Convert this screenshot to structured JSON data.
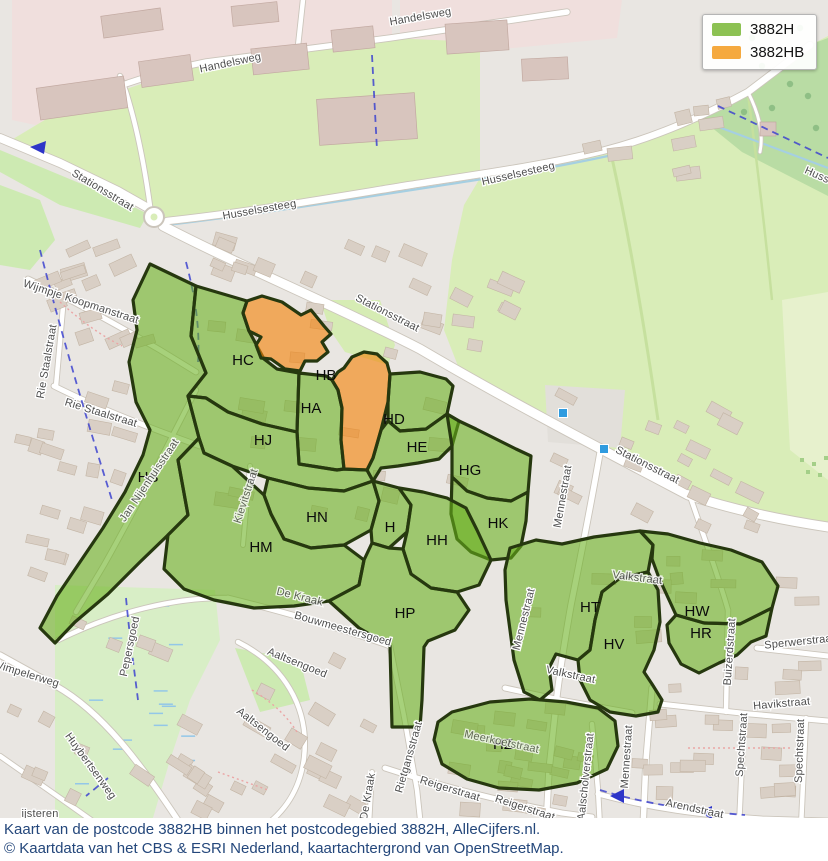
{
  "legend": {
    "items": [
      {
        "label": "3882H",
        "color": "#8cc152"
      },
      {
        "label": "3882HB",
        "color": "#f5a93f"
      }
    ]
  },
  "caption": {
    "line1": "Kaart van de postcode 3882HB binnen het postcodegebied 3882H, AlleCijfers.nl.",
    "line2": "© Kaartdata van het CBS & ESRI Nederland, kaartachtergrond van OpenStreetMap."
  },
  "colors": {
    "base": "#e9e6e2",
    "zone_green_fill": "rgba(104,176,28,0.58)",
    "zone_orange_fill": "rgba(243,130,10,0.62)",
    "zone_stroke": "#26380f",
    "road_casing": "#cbc5bb",
    "road_fill": "#ffffff",
    "stream": "#a5cfe2",
    "cycleway": "#3d43cf",
    "building": "#d9cfc5",
    "building_stroke": "#c3b5a5",
    "industrial_building": "#d8c5be",
    "bus_stop": "#2f9bdf"
  },
  "map": {
    "zone_polygons": [
      {
        "id": "HS",
        "type": "h",
        "points": "150,264 196,286 191,336 206,373 188,396 199,438 178,460 188,515 168,535 140,562 108,594 75,622 55,643 40,628 57,596 80,562 103,528 125,492 143,455 150,430 136,402 129,362 137,330 133,300"
      },
      {
        "id": "HC",
        "type": "h",
        "points": "196,286 247,301 243,313 249,331 257,346 264,359 277,369 299,373 297,432 262,424 228,412 206,398 188,396 206,373 191,336"
      },
      {
        "id": "HA",
        "type": "h",
        "points": "299,373 326,376 332,380 338,390 342,408 341,440 344,469 337,470 299,464 297,432"
      },
      {
        "id": "HJ",
        "type": "h",
        "points": "188,396 206,398 228,412 262,424 297,432 299,464 337,470 344,469 367,470 373,481 344,491 308,488 268,478 232,466 204,453 199,438"
      },
      {
        "id": "HD",
        "type": "h",
        "points": "390,374 420,372 446,379 453,386 447,414 426,429 400,431 388,421 388,402"
      },
      {
        "id": "HE",
        "type": "h",
        "points": "388,421 400,431 426,429 447,414 459,421 452,446 439,459 418,463 398,466 381,468 373,481 367,470 373,458 381,430"
      },
      {
        "id": "HG",
        "type": "h",
        "points": "447,414 459,421 476,429 496,439 516,449 531,456 528,492 511,501 487,498 467,491 452,477 452,446"
      },
      {
        "id": "HK",
        "type": "h",
        "points": "452,477 467,491 487,498 511,501 528,492 526,521 521,546 511,558 491,560 471,552 457,539 451,514"
      },
      {
        "id": "HN",
        "type": "h",
        "points": "268,478 308,488 344,491 373,481 379,501 371,530 344,545 311,548 284,539 271,514 264,495"
      },
      {
        "id": "H",
        "type": "h",
        "points": "373,481 399,488 411,505 407,532 389,548 372,543 371,530 379,501"
      },
      {
        "id": "HH",
        "type": "h",
        "points": "399,488 423,492 447,498 466,508 477,530 491,560 479,585 457,592 431,588 411,574 403,549 407,532 411,505"
      },
      {
        "id": "HM",
        "type": "h",
        "points": "199,438 204,453 232,466 264,495 271,514 284,539 311,548 344,545 364,560 359,585 329,601 294,606 254,608 214,600 184,589 164,569 168,535 188,515 178,460"
      },
      {
        "id": "HP",
        "type": "h",
        "points": "364,560 372,543 389,548 403,549 411,574 431,588 457,592 469,610 455,630 428,641 424,647 422,700 420,727 392,727 390,646 359,628 329,601 359,585"
      },
      {
        "id": "HT",
        "type": "h",
        "points": "510,548 536,540 562,544 594,537 640,531 653,545 648,572 620,578 602,592 595,620 590,650 578,660 556,654 549,668 552,690 540,700 524,692 514,660 506,600 505,570"
      },
      {
        "id": "HV",
        "type": "h",
        "points": "595,620 602,592 620,578 648,572 658,590 660,622 654,650 644,672 652,684 662,700 658,712 636,716 610,712 590,700 580,680 578,660 590,650"
      },
      {
        "id": "HW",
        "type": "h",
        "points": "640,531 668,534 700,543 731,550 762,562 778,586 772,608 740,624 704,623 676,615 659,578 652,559 653,545"
      },
      {
        "id": "HR",
        "type": "h",
        "points": "676,615 704,623 740,624 772,608 766,636 751,642 737,655 719,663 699,673 681,664 669,643 667,625"
      },
      {
        "id": "HZ",
        "type": "h",
        "points": "452,712 490,702 530,699 566,702 598,708 615,721 618,746 607,769 577,783 539,790 499,788 467,779 442,764 434,740 438,722"
      },
      {
        "id": "HB1",
        "type": "hb",
        "points": "247,301 262,296 282,302 301,315 311,310 324,326 331,334 322,342 328,352 317,361 305,361 300,371 285,369 271,359 261,358 256,345 261,337 249,331 243,313"
      },
      {
        "id": "HB2",
        "type": "hb",
        "points": "332,380 338,372 344,368 352,357 364,352 377,354 387,363 390,374 388,402 381,430 373,458 367,470 344,469 341,440 342,408 338,390"
      }
    ],
    "zone_labels": [
      {
        "t": "HC",
        "x": 243,
        "y": 365
      },
      {
        "t": "HB",
        "x": 326,
        "y": 380
      },
      {
        "t": "HA",
        "x": 311,
        "y": 413
      },
      {
        "t": "HD",
        "x": 394,
        "y": 424
      },
      {
        "t": "HE",
        "x": 417,
        "y": 452
      },
      {
        "t": "HG",
        "x": 470,
        "y": 475
      },
      {
        "t": "HJ",
        "x": 263,
        "y": 445
      },
      {
        "t": "HS",
        "x": 148,
        "y": 482
      },
      {
        "t": "HN",
        "x": 317,
        "y": 522
      },
      {
        "t": "HM",
        "x": 261,
        "y": 552
      },
      {
        "t": "H",
        "x": 390,
        "y": 532
      },
      {
        "t": "HH",
        "x": 437,
        "y": 545
      },
      {
        "t": "HK",
        "x": 498,
        "y": 528
      },
      {
        "t": "HP",
        "x": 405,
        "y": 618
      },
      {
        "t": "HT",
        "x": 590,
        "y": 612
      },
      {
        "t": "HV",
        "x": 614,
        "y": 649
      },
      {
        "t": "HW",
        "x": 697,
        "y": 616
      },
      {
        "t": "HR",
        "x": 701,
        "y": 638
      },
      {
        "t": "HZ",
        "x": 503,
        "y": 749
      }
    ],
    "street_labels": [
      {
        "t": "Handelsweg",
        "x": 231,
        "y": 66,
        "r": -12
      },
      {
        "t": "Handelsweg",
        "x": 421,
        "y": 20,
        "r": -10
      },
      {
        "t": "Stationsstraat",
        "x": 101,
        "y": 193,
        "r": 31,
        "s": 12
      },
      {
        "t": "Stationsstraat",
        "x": 386,
        "y": 316,
        "r": 27,
        "s": 12
      },
      {
        "t": "Stationsstraat",
        "x": 646,
        "y": 468,
        "r": 27,
        "s": 12
      },
      {
        "t": "Husselsesteeg",
        "x": 260,
        "y": 213,
        "r": -10
      },
      {
        "t": "Husselsesteeg",
        "x": 519,
        "y": 177,
        "r": -13
      },
      {
        "t": "Husselsesteeg",
        "x": 838,
        "y": 188,
        "r": 24
      },
      {
        "t": "Wijmpje Koopmanstraat",
        "x": 80,
        "y": 305,
        "r": 18,
        "s": 10.5
      },
      {
        "t": "Rie Staalstraat",
        "x": 100,
        "y": 416,
        "r": 17
      },
      {
        "t": "Rie Staalstraat",
        "x": 50,
        "y": 362,
        "r": -80
      },
      {
        "t": "Jan Nijenhuisstraat",
        "x": 152,
        "y": 482,
        "r": -56,
        "c": "#63705a",
        "o": 0.9,
        "s": 10.5
      },
      {
        "t": "Kievitstraat",
        "x": 249,
        "y": 497,
        "r": -72,
        "c": "#5d7a4a",
        "o": 0.8,
        "s": 10.5
      },
      {
        "t": "Mennestraat",
        "x": 566,
        "y": 497,
        "r": -80
      },
      {
        "t": "Mennestraat",
        "x": 527,
        "y": 620,
        "r": -76
      },
      {
        "t": "Mennestraat",
        "x": 630,
        "y": 757,
        "r": -86
      },
      {
        "t": "De Kraak",
        "x": 299,
        "y": 600,
        "r": 14,
        "c": "#5d7a4a",
        "o": 0.85
      },
      {
        "t": "De Kraak",
        "x": 371,
        "y": 797,
        "r": -80
      },
      {
        "t": "Bouwmeestersgoed",
        "x": 342,
        "y": 632,
        "r": 16
      },
      {
        "t": "Pepersgoed",
        "x": 133,
        "y": 647,
        "r": -78
      },
      {
        "t": "Wimpelerweg",
        "x": 25,
        "y": 677,
        "r": 17
      },
      {
        "t": "Huybertsenweg",
        "x": 88,
        "y": 768,
        "r": 54
      },
      {
        "t": "Aaltsengoed",
        "x": 261,
        "y": 732,
        "r": 38
      },
      {
        "t": "Aaltsengoed",
        "x": 296,
        "y": 666,
        "r": 22
      },
      {
        "t": "Valkstraat",
        "x": 637,
        "y": 581,
        "r": 7,
        "c": "#5d7a4a",
        "o": 0.85
      },
      {
        "t": "Valkstraat",
        "x": 570,
        "y": 678,
        "r": 12
      },
      {
        "t": "Sperwerstraat",
        "x": 800,
        "y": 645,
        "r": -6
      },
      {
        "t": "Havikstraat",
        "x": 782,
        "y": 707,
        "r": -5
      },
      {
        "t": "Spechtstraat",
        "x": 745,
        "y": 745,
        "r": -86
      },
      {
        "t": "Spechtstraat",
        "x": 803,
        "y": 751,
        "r": -88
      },
      {
        "t": "Buizerdstraat",
        "x": 733,
        "y": 652,
        "r": -86
      },
      {
        "t": "Rietgansstraat",
        "x": 412,
        "y": 758,
        "r": -74
      },
      {
        "t": "Reigerstraat",
        "x": 449,
        "y": 792,
        "r": 17
      },
      {
        "t": "Reigerstraat",
        "x": 524,
        "y": 811,
        "r": 18
      },
      {
        "t": "Meerkoetstraat",
        "x": 501,
        "y": 745,
        "r": 12,
        "c": "#5d7a4a",
        "o": 0.75
      },
      {
        "t": "Aalscholverstraat",
        "x": 589,
        "y": 777,
        "r": -84
      },
      {
        "t": "Arendstraat",
        "x": 694,
        "y": 812,
        "r": 12
      },
      {
        "t": "ijsteren",
        "x": 40,
        "y": 817,
        "r": 0,
        "s": 14,
        "c": "#8a8a8a"
      }
    ],
    "landuse": [
      {
        "f": "#f0dfdd",
        "d": "M12,120 L12,0 L392,0 L392,40 L206,62 L92,98 L40,126 Z"
      },
      {
        "f": "#f0dfdd",
        "d": "M400,0 L622,0 L617,38 L472,52 L400,40 Z"
      },
      {
        "f": "#d9edb8",
        "d": "M58,112 L206,62 L390,38 L480,42 L480,178 L400,187 L300,202 L200,216 L166,222 L120,192 L60,164 L8,142 Z"
      },
      {
        "f": "#d9edb8",
        "d": "M480,178 L602,151 L650,139 L700,118 L748,92 L812,44 L828,36 L828,527 L786,520 L738,511 L686,494 L594,445 L504,398 L458,366 L444,330 L452,260 L464,205 Z"
      },
      {
        "f": "#b9dca4",
        "d": "M700,118 L748,92 L812,44 L828,38 L828,196 L742,152 Z"
      },
      {
        "f": "#e7f1cd",
        "d": "M782,300 L828,292 L828,480 L790,450 Z"
      },
      {
        "f": "#cdeab2",
        "d": "M0,185 L40,200 L55,240 L30,270 L0,265 Z"
      },
      {
        "f": "#cdeab2",
        "d": "M0,150 L60,175 L120,200 L148,214 L140,228 L60,205 L0,172 Z"
      },
      {
        "f": "#d8eec6",
        "d": "M55,585 L215,590 L220,640 L190,700 L170,760 L150,828 L55,828 Z"
      },
      {
        "f": "#cdeab2",
        "d": "M235,648 L300,660 L310,700 L260,712 Z"
      },
      {
        "f": "#d6ecb4",
        "d": "M320,300 L380,300 L395,345 L388,365 L345,352 L330,330 Z"
      },
      {
        "f": "#e2dfda",
        "d": "M545,385 L625,390 L620,448 L548,442 Z"
      }
    ],
    "hedges": [
      {
        "d": "M612,158 C630,240 645,330 658,420",
        "c": "#c6e09e",
        "w": 3
      },
      {
        "d": "M748,94 C758,170 766,240 772,300",
        "c": "#c6e09e",
        "w": 2.5
      }
    ],
    "trees": [
      {
        "x": 762,
        "y": 66
      },
      {
        "x": 790,
        "y": 84
      },
      {
        "x": 772,
        "y": 108
      },
      {
        "x": 808,
        "y": 96
      },
      {
        "x": 752,
        "y": 38
      },
      {
        "x": 800,
        "y": 28
      },
      {
        "x": 816,
        "y": 128
      },
      {
        "x": 768,
        "y": 132
      },
      {
        "x": 744,
        "y": 112
      }
    ],
    "orchard": [
      {
        "x": 800,
        "y": 458
      },
      {
        "x": 812,
        "y": 462
      },
      {
        "x": 824,
        "y": 456
      },
      {
        "x": 806,
        "y": 470
      },
      {
        "x": 818,
        "y": 473
      }
    ],
    "wetland": {
      "x": 75,
      "y": 595,
      "w": 115,
      "h": 205,
      "n": 14
    },
    "streams": [
      "M167,225 C260,214 360,198 470,181 C540,170 580,162 608,156",
      "M700,120 L828,168"
    ],
    "roads": [
      {
        "d": "M0,138 L60,163 L118,191 L148,208",
        "w": 8
      },
      {
        "d": "M163,226 C240,266 330,303 420,349 C505,399 595,446 688,495 C740,512 788,521 828,527",
        "w": 9
      },
      {
        "d": "M167,221 C250,212 330,198 410,185 C480,174 545,165 602,151 C650,139 700,118 748,92 L810,45",
        "w": 6.5
      },
      {
        "d": "M55,113 C95,94 145,74 206,62 L390,38 L567,12",
        "w": 5.5
      },
      {
        "d": "M298,46 L303,0",
        "w": 4.5
      },
      {
        "d": "M150,206 C145,170 138,130 126,92 L120,76",
        "w": 4.5
      },
      {
        "d": "M601,447 C591,505 581,555 571,605 C564,645 559,675 556,705 L549,770 L546,828",
        "w": 5.5
      },
      {
        "d": "M652,688 L646,760 L643,828",
        "w": 5.5
      },
      {
        "d": "M505,688 L560,700 L632,713",
        "w": 5
      },
      {
        "d": "M757,648 L828,656",
        "w": 5
      },
      {
        "d": "M690,496 C705,540 718,575 728,610",
        "w": 4.5
      },
      {
        "d": "M728,610 L726,712",
        "w": 4.5
      },
      {
        "d": "M660,704 L750,714 L828,721",
        "w": 5
      },
      {
        "d": "M744,716 L739,828",
        "w": 4.5
      },
      {
        "d": "M806,718 L801,828",
        "w": 4.5
      },
      {
        "d": "M598,794 C650,808 700,815 762,819 L828,821",
        "w": 5
      },
      {
        "d": "M385,768 C440,786 500,801 562,813 L592,817",
        "w": 5
      },
      {
        "d": "M404,716 L417,790 L421,828",
        "w": 4.5
      },
      {
        "d": "M390,646 L404,716",
        "w": 4.5
      },
      {
        "d": "M592,724 L598,790 L600,828",
        "w": 4.5
      },
      {
        "d": "M228,598 C280,611 335,626 390,646",
        "w": 5
      },
      {
        "d": "M58,640 C115,612 175,597 228,598",
        "w": 4.5
      },
      {
        "d": "M372,772 L369,828",
        "w": 4
      },
      {
        "d": "M0,655 L56,686 C102,712 140,762 183,828",
        "w": 5.5
      },
      {
        "d": "M0,756 L60,798 L108,832",
        "w": 4.5
      },
      {
        "d": "M28,279 C72,300 112,322 160,350 L196,372",
        "w": 5
      },
      {
        "d": "M54,386 C100,409 150,428 200,446",
        "w": 5
      },
      {
        "d": "M64,296 L56,386",
        "w": 4.5
      },
      {
        "d": "M238,642 C282,664 310,706 304,758 C300,790 285,812 262,828",
        "w": 4.5
      },
      {
        "d": "M196,390 C168,444 138,505 104,565 L76,612",
        "w": 4.5
      },
      {
        "d": "M250,466 L243,545",
        "w": 4
      },
      {
        "d": "M748,92 C758,112 764,132 760,152",
        "w": 3
      }
    ],
    "roundabout": {
      "x": 154,
      "y": 217,
      "r": 10
    },
    "industrial_buildings": [
      {
        "x": 38,
        "y": 82,
        "w": 88,
        "h": 32,
        "r": -8
      },
      {
        "x": 140,
        "y": 58,
        "w": 52,
        "h": 26,
        "r": -8
      },
      {
        "x": 252,
        "y": 46,
        "w": 56,
        "h": 26,
        "r": -6
      },
      {
        "x": 318,
        "y": 96,
        "w": 98,
        "h": 46,
        "r": -4
      },
      {
        "x": 332,
        "y": 28,
        "w": 42,
        "h": 22,
        "r": -6
      },
      {
        "x": 446,
        "y": 22,
        "w": 62,
        "h": 30,
        "r": -4
      },
      {
        "x": 522,
        "y": 58,
        "w": 46,
        "h": 22,
        "r": -3
      },
      {
        "x": 232,
        "y": 4,
        "w": 46,
        "h": 20,
        "r": -6
      },
      {
        "x": 102,
        "y": 12,
        "w": 60,
        "h": 22,
        "r": -8
      },
      {
        "x": 760,
        "y": 122,
        "w": 16,
        "h": 14,
        "r": 0
      }
    ],
    "building_clusters": [
      {
        "x": 15,
        "y": 225,
        "w": 150,
        "h": 135,
        "n": 15,
        "a": -20
      },
      {
        "x": 15,
        "y": 370,
        "w": 125,
        "h": 115,
        "n": 11,
        "a": 15
      },
      {
        "x": 0,
        "y": 495,
        "w": 110,
        "h": 85,
        "n": 7,
        "a": 15
      },
      {
        "x": 210,
        "y": 228,
        "w": 125,
        "h": 62,
        "n": 8,
        "a": 20
      },
      {
        "x": 345,
        "y": 242,
        "w": 180,
        "h": 90,
        "n": 10,
        "a": 25
      },
      {
        "x": 550,
        "y": 98,
        "w": 195,
        "h": 85,
        "n": 9,
        "a": -10
      },
      {
        "x": 545,
        "y": 392,
        "w": 225,
        "h": 145,
        "n": 20,
        "a": 25
      },
      {
        "x": 775,
        "y": 555,
        "w": 50,
        "h": 140,
        "n": 5,
        "a": 0
      },
      {
        "x": 628,
        "y": 692,
        "w": 190,
        "h": 125,
        "n": 17,
        "a": 0
      },
      {
        "x": 415,
        "y": 692,
        "w": 175,
        "h": 125,
        "n": 14,
        "a": 8
      },
      {
        "x": 228,
        "y": 640,
        "w": 150,
        "h": 180,
        "n": 15,
        "a": 30
      },
      {
        "x": 0,
        "y": 700,
        "w": 105,
        "h": 115,
        "n": 6,
        "a": 25
      },
      {
        "x": 128,
        "y": 718,
        "w": 105,
        "h": 105,
        "n": 9,
        "a": 30
      },
      {
        "x": 200,
        "y": 300,
        "w": 290,
        "h": 270,
        "n": 24,
        "a": 10
      },
      {
        "x": 520,
        "y": 545,
        "w": 235,
        "h": 150,
        "n": 12,
        "a": 0
      },
      {
        "x": 445,
        "y": 705,
        "w": 160,
        "h": 75,
        "n": 7,
        "a": 10
      },
      {
        "x": 60,
        "y": 588,
        "w": 120,
        "h": 80,
        "n": 5,
        "a": 20
      }
    ],
    "red_paths": [
      "M252,690 C272,702 287,716 297,732",
      "M688,748 L792,748",
      "M60,302 C82,322 102,336 122,346",
      "M218,772 L268,790"
    ],
    "cycleways": [
      "M40,250 C58,320 78,392 112,500",
      "M372,55 L377,150",
      "M126,598 C130,640 134,668 138,700",
      "M718,106 L828,158",
      "M186,262 C196,300 200,330 198,362",
      "M600,790 C645,804 695,811 745,815",
      "M108,778 L86,796"
    ],
    "arrows": [
      {
        "p": "46,141 30,147 44,154"
      },
      {
        "p": "624,789 610,796 624,803"
      },
      {
        "p": "712,806 698,812 712,819"
      }
    ],
    "bus_stops": [
      {
        "x": 563,
        "y": 413
      },
      {
        "x": 604,
        "y": 449
      }
    ]
  }
}
